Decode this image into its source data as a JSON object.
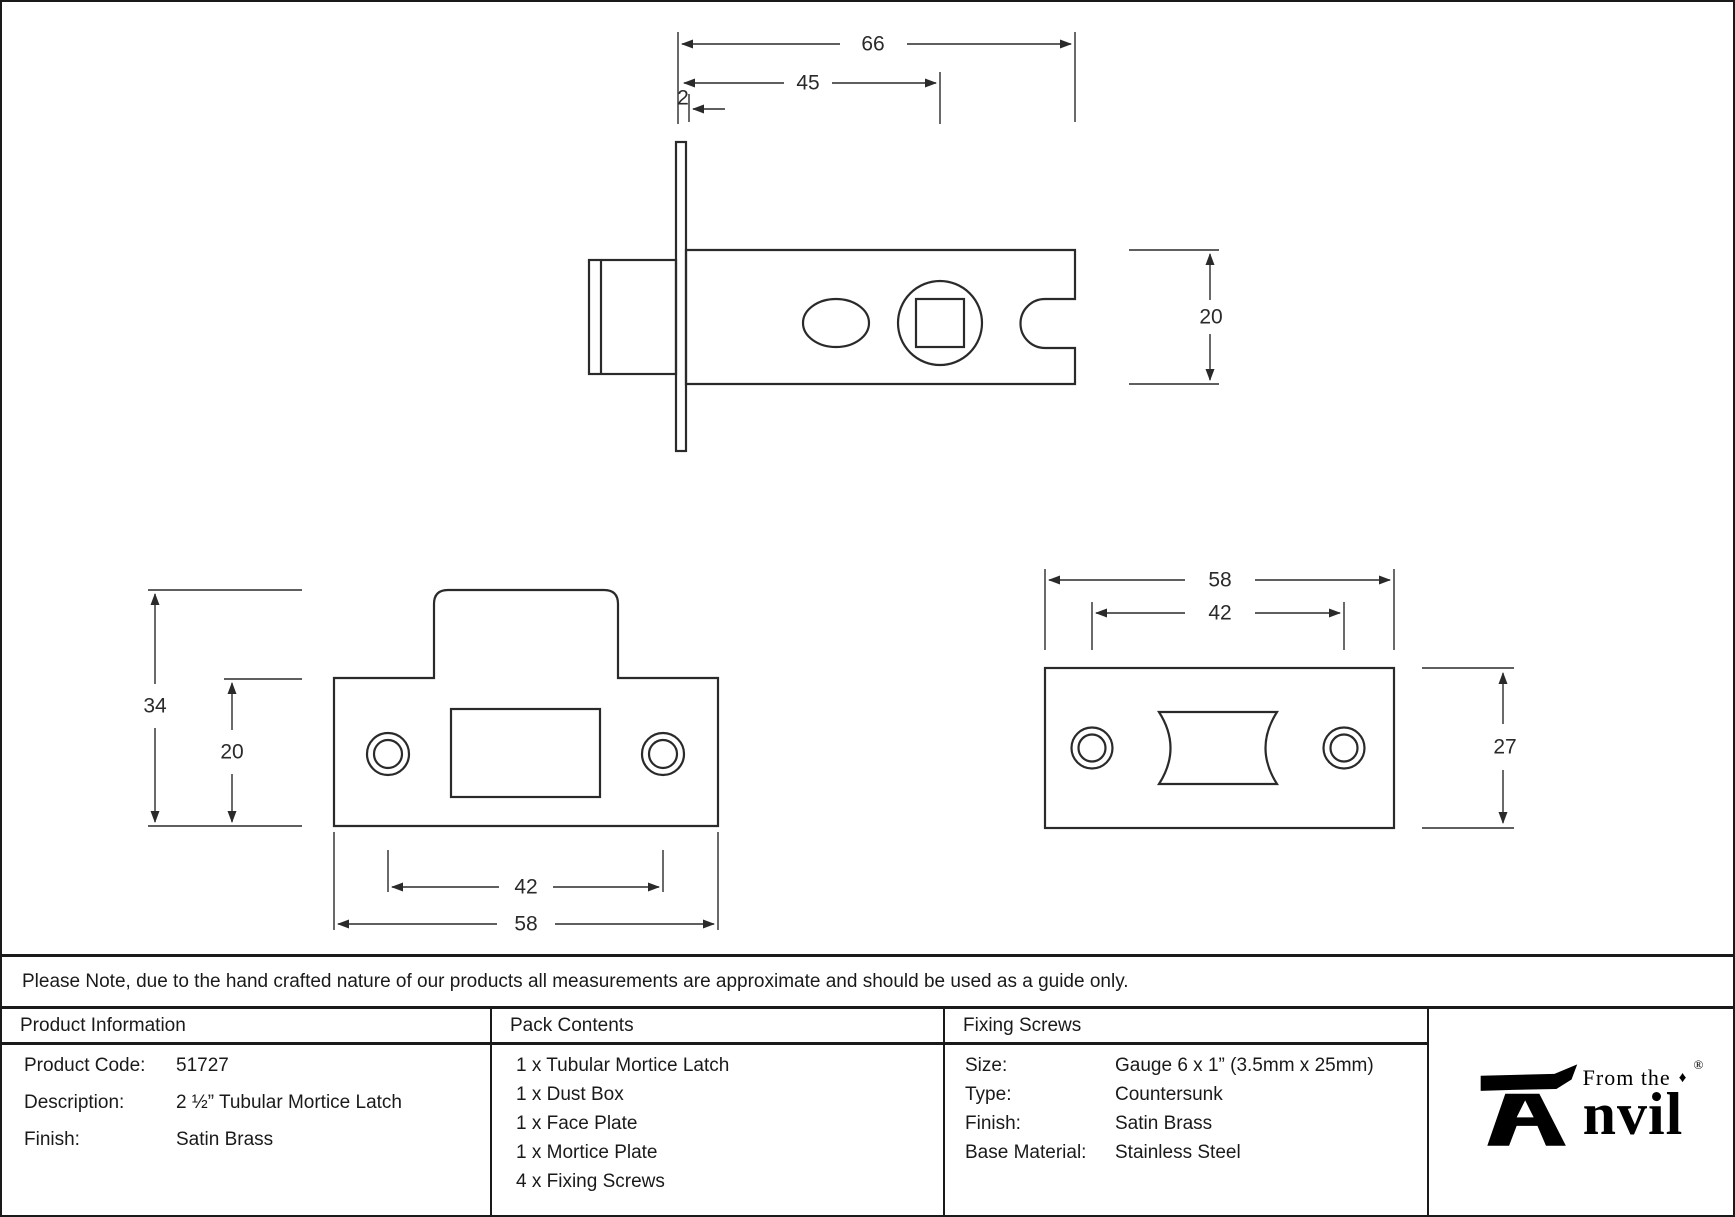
{
  "note": {
    "text": "Please Note, due to the hand crafted nature of our products all measurements are approximate and should be used as a guide only."
  },
  "dims": {
    "side_overall_length": "66",
    "side_backset": "45",
    "side_faceplate_thickness": "2",
    "side_case_height": "20",
    "faceplate_overall_height": "34",
    "faceplate_plate_height": "20",
    "faceplate_screw_centres": "42",
    "faceplate_width": "58",
    "mortice_width": "58",
    "mortice_screw_centres": "42",
    "mortice_height": "27"
  },
  "table": {
    "product_info": {
      "header": "Product Information",
      "rows": [
        {
          "label": "Product Code:",
          "value": "51727"
        },
        {
          "label": "Description:",
          "value": "2 ½” Tubular Mortice Latch"
        },
        {
          "label": "Finish:",
          "value": "Satin Brass"
        }
      ]
    },
    "pack_contents": {
      "header": "Pack Contents",
      "items": [
        "1 x Tubular Mortice Latch",
        "1 x Dust Box",
        "1 x Face Plate",
        "1 x Mortice Plate",
        "4 x Fixing Screws"
      ]
    },
    "fixing_screws": {
      "header": "Fixing Screws",
      "rows": [
        {
          "label": "Size:",
          "value": "Gauge 6 x 1” (3.5mm x 25mm)"
        },
        {
          "label": "Type:",
          "value": "Countersunk"
        },
        {
          "label": "Finish:",
          "value": "Satin Brass"
        },
        {
          "label": "Base Material:",
          "value": "Stainless Steel"
        }
      ]
    }
  },
  "logo": {
    "from_the": "From the",
    "diamond": "♦",
    "name_suffix": "nvil",
    "registered": "®"
  }
}
